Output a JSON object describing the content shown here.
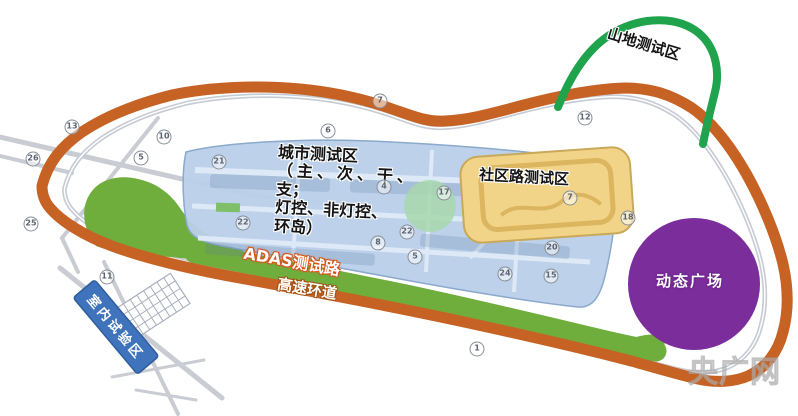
{
  "map": {
    "zones": {
      "mountain": {
        "label": "山地测试区",
        "color": "#1fa34d"
      },
      "urban": {
        "label": "城市测试区",
        "details": [
          "（主、次、干、",
          "支；",
          "灯控、非灯控、",
          "环岛）"
        ],
        "color": "#b9d0e9"
      },
      "community": {
        "label": "社区路测试区",
        "color": "#f2d488"
      },
      "adas_road": {
        "label": "ADAS测试路",
        "color": "#6fae3d"
      },
      "highspeed_ring": {
        "label": "高速环道",
        "color": "#c66223"
      },
      "dynamic_plaza": {
        "label": "动态广场",
        "color": "#7b2d9b"
      },
      "indoor": {
        "label": "室内试验区",
        "color": "#3f74bc"
      }
    },
    "road_markers": [
      {
        "value": "13",
        "x": 72,
        "y": 127
      },
      {
        "value": "26",
        "x": 33,
        "y": 159
      },
      {
        "value": "10",
        "x": 164,
        "y": 137
      },
      {
        "value": "5",
        "x": 141,
        "y": 158
      },
      {
        "value": "25",
        "x": 31,
        "y": 224
      },
      {
        "value": "11",
        "x": 107,
        "y": 277
      },
      {
        "value": "6",
        "x": 328,
        "y": 131
      },
      {
        "value": "7",
        "x": 380,
        "y": 101
      },
      {
        "value": "12",
        "x": 585,
        "y": 118
      },
      {
        "value": "21",
        "x": 219,
        "y": 162
      },
      {
        "value": "22",
        "x": 243,
        "y": 223
      },
      {
        "value": "4",
        "x": 384,
        "y": 187
      },
      {
        "value": "17",
        "x": 444,
        "y": 193
      },
      {
        "value": "22",
        "x": 407,
        "y": 232
      },
      {
        "value": "8",
        "x": 378,
        "y": 243
      },
      {
        "value": "5",
        "x": 415,
        "y": 257
      },
      {
        "value": "7",
        "x": 570,
        "y": 198
      },
      {
        "value": "18",
        "x": 628,
        "y": 218
      },
      {
        "value": "20",
        "x": 552,
        "y": 248
      },
      {
        "value": "24",
        "x": 505,
        "y": 274
      },
      {
        "value": "15",
        "x": 551,
        "y": 276
      },
      {
        "value": "1",
        "x": 477,
        "y": 349
      }
    ],
    "watermark": "央广网"
  }
}
